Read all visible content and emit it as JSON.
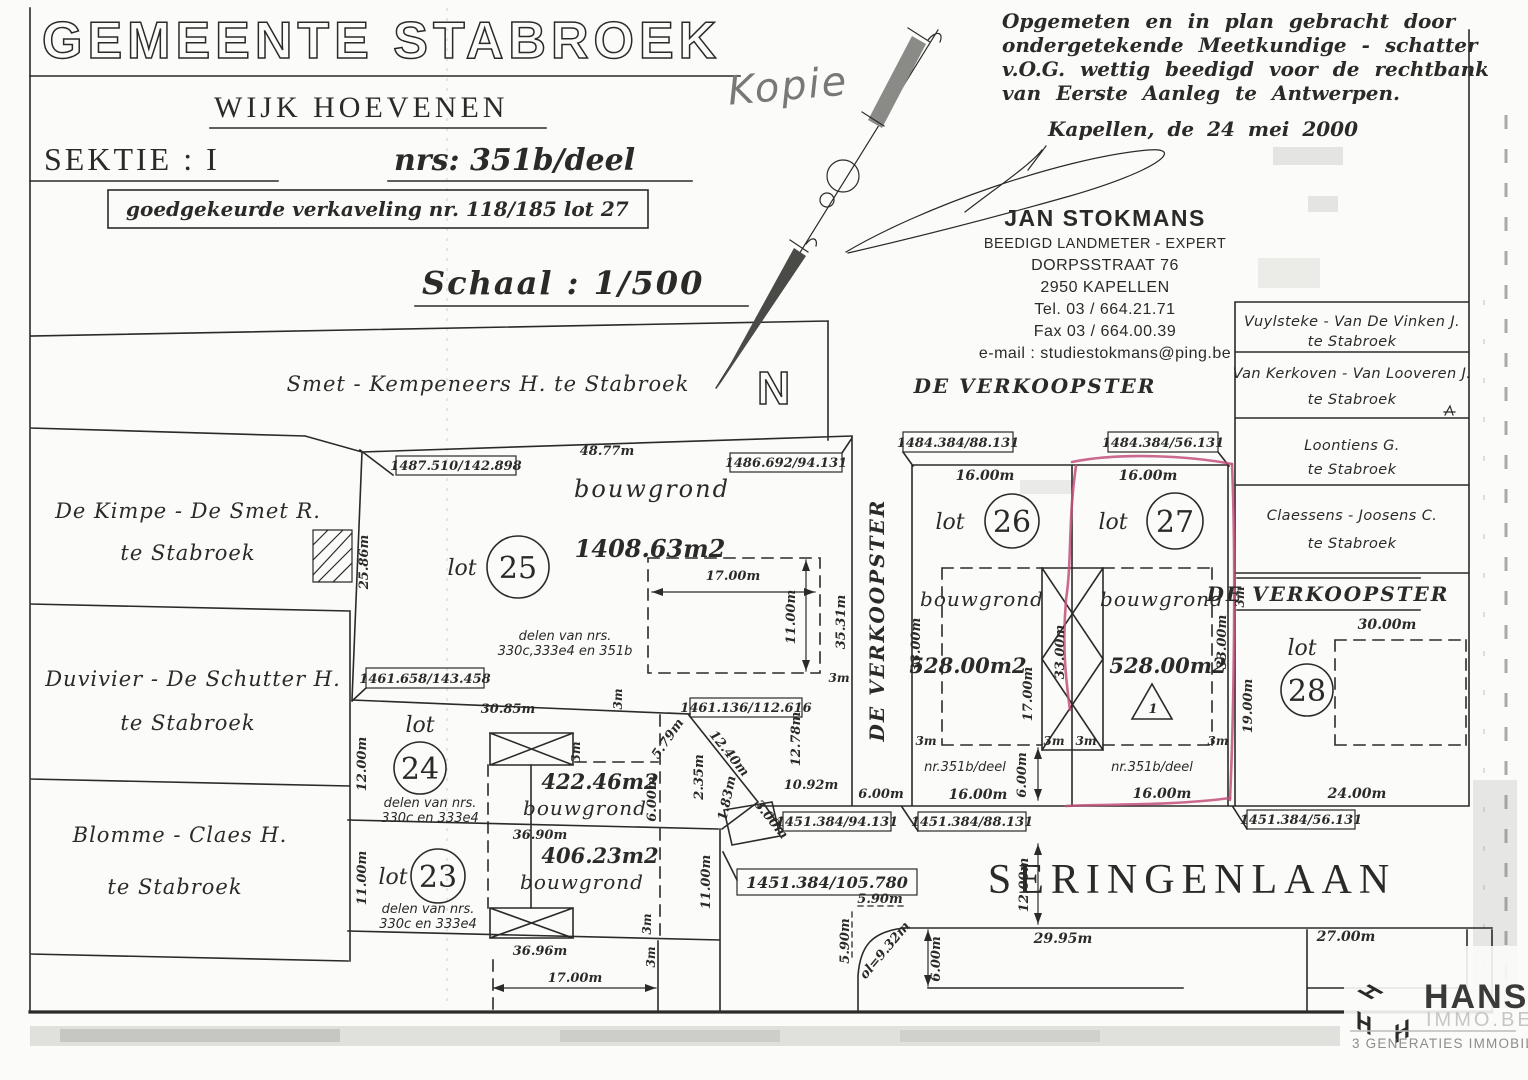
{
  "header": {
    "municipality": "GEMEENTE STABROEK",
    "copy_mark": "Kopie",
    "district": "WIJK HOEVENEN",
    "section": "SEKTIE : I",
    "numbers": "nrs: 351b/deel",
    "approval": "goedgekeurde verkaveling nr. 118/185  lot 27",
    "scale": "Schaal : 1/500",
    "north": "N"
  },
  "surveyor": {
    "statement": [
      "Opgemeten  en  in  plan gebracht door",
      "ondergetekende  Meetkundige - schatter",
      "v.O.G.  wettig  beedigd  voor  de  rechtbank",
      "van Eerste Aanleg te Antwerpen."
    ],
    "dateline": "Kapellen, de   24 mei 2000",
    "name": "JAN STOKMANS",
    "role": "BEEDIGD LANDMETER - EXPERT",
    "street": "DORPSSTRAAT 76",
    "city": "2950   KAPELLEN",
    "tel": "Tel. 03 / 664.21.71",
    "fax": "Fax 03 / 664.00.39",
    "email": "e-mail : studiestokmans@ping.be"
  },
  "neighbors": {
    "north": "Smet - Kempeneers H.  te Stabroek",
    "west": [
      {
        "name": "De Kimpe - De Smet R.",
        "place": "te Stabroek"
      },
      {
        "name": "Duvivier - De Schutter H.",
        "place": "te Stabroek"
      },
      {
        "name": "Blomme - Claes H.",
        "place": "te Stabroek"
      }
    ],
    "east": [
      {
        "name": "Vuylsteke - Van De Vinken J.",
        "place": "te Stabroek"
      },
      {
        "name": "Van Kerkoven - Van Looveren J.",
        "place": "te Stabroek"
      },
      {
        "name": "Loontiens G.",
        "place": "te Stabroek"
      },
      {
        "name": "Claessens - Joosens C.",
        "place": "te Stabroek"
      }
    ]
  },
  "seller": {
    "west_strip": "DE VERKOOPSTER",
    "center": "DE VERKOOPSTER",
    "east": "DE VERKOOPSTER"
  },
  "street": {
    "name": "SERINGENLAAN"
  },
  "lots": {
    "l23": {
      "lot": "lot",
      "num": "23",
      "area": "406.23m2",
      "use": "bouwgrond",
      "sub1": "delen van nrs.",
      "sub2": "330c en 333e4"
    },
    "l24": {
      "lot": "lot",
      "num": "24",
      "area": "422.46m2",
      "use": "bouwgrond",
      "sub1": "delen van nrs.",
      "sub2": "330c en 333e4"
    },
    "l25": {
      "lot": "lot",
      "num": "25",
      "area": "1408.63m2",
      "use": "bouwgrond",
      "sub1": "delen van nrs.",
      "sub2": "330c,333e4 en 351b"
    },
    "l26": {
      "lot": "lot",
      "num": "26",
      "area": "528.00m2",
      "use": "bouwgrond",
      "parcel": "nr.351b/deel"
    },
    "l27": {
      "lot": "lot",
      "num": "27",
      "area": "528.00m2",
      "use": "bouwgrond",
      "parcel": "nr.351b/deel",
      "marker": "1"
    },
    "l28": {
      "lot": "lot",
      "num": "28"
    }
  },
  "boxes": {
    "b1": "1487.510/142.898",
    "b2": "1486.692/94.131",
    "b3": "1461.658/143.458",
    "b4": "1461.136/112.616",
    "b5": "1484.384/88.131",
    "b6": "1484.384/56.131",
    "b7": "1451.384/94.131",
    "b8": "1451.384/88.131",
    "b9": "1451.384/105.780",
    "b10": "1451.384/56.131"
  },
  "dims": {
    "d48_77": "48.77m",
    "d25_86": "25.86m",
    "d30_85": "30.85m",
    "d35_31": "35.31m",
    "d36_90": "36.90m",
    "d36_96": "36.96m",
    "d12_00": "12.00m",
    "d11_00": "11.00m",
    "d17_00": "17.00m",
    "d16_00": "16.00m",
    "d33_00": "33.00m",
    "d6_00": "6.00m",
    "d3": "3m",
    "d5_79": "5.79m",
    "d12_40": "12.40m",
    "d2_35": "2.35m",
    "d1_83": "1.83m",
    "d3_00": "3.00m",
    "d12_78": "12.78m",
    "d10_92": "10.92m",
    "d19_00": "19.00m",
    "d30_00": "30.00m",
    "d24_00": "24.00m",
    "d29_95": "29.95m",
    "d27_00": "27.00m",
    "d5_90": "5.90m",
    "d9_32": "ol=9.32m"
  },
  "logo": {
    "monogram": "H",
    "brand": "HANS",
    "domain": "IMMO.BE",
    "tagline": "3 GENERATIES IMMOBILIËN"
  },
  "colors": {
    "ink": "#2b2a26",
    "highlight": "#c2507b",
    "brand_yellow": "#f2b100",
    "brand_gray": "#9a9a9a",
    "brand_dark": "#3c3c3b"
  }
}
